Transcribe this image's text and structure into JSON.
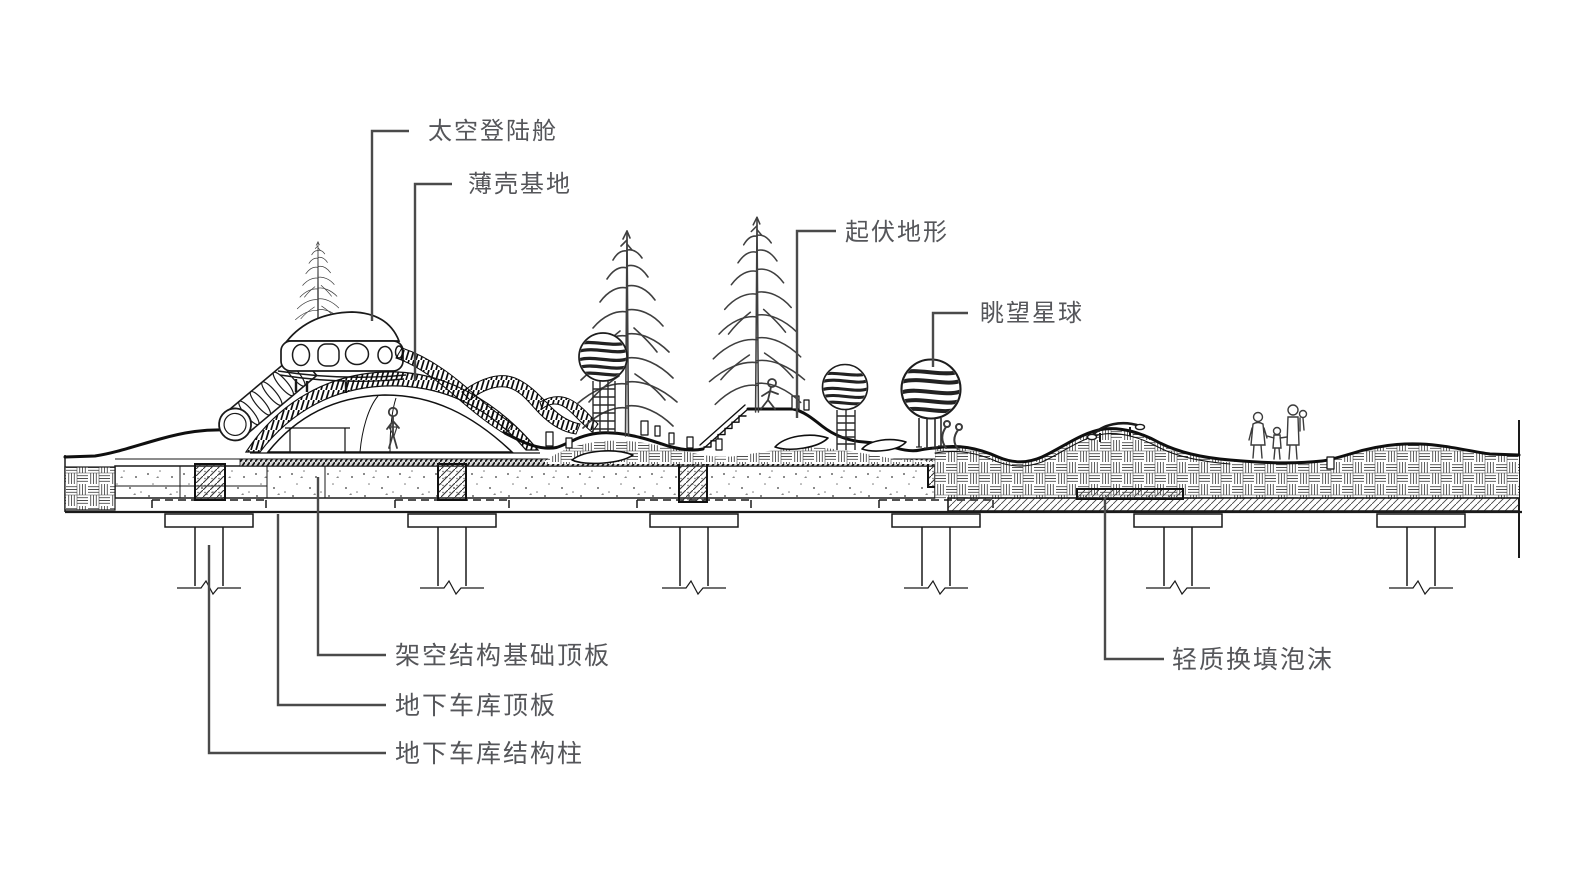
{
  "drawing": {
    "background": "#ffffff",
    "line_color": "#1a1a1a",
    "label_color": "#55565a",
    "callouts": {
      "space_capsule": "太空登陆舱",
      "shell_base": "薄壳基地",
      "rolling_terrain": "起伏地形",
      "star_lookout": "眺望星球",
      "elevated_foundation_slab": "架空结构基础顶板",
      "garage_roof_slab": "地下车库顶板",
      "garage_column": "地下车库结构柱",
      "lightweight_foam": "轻质换填泡沫"
    }
  }
}
